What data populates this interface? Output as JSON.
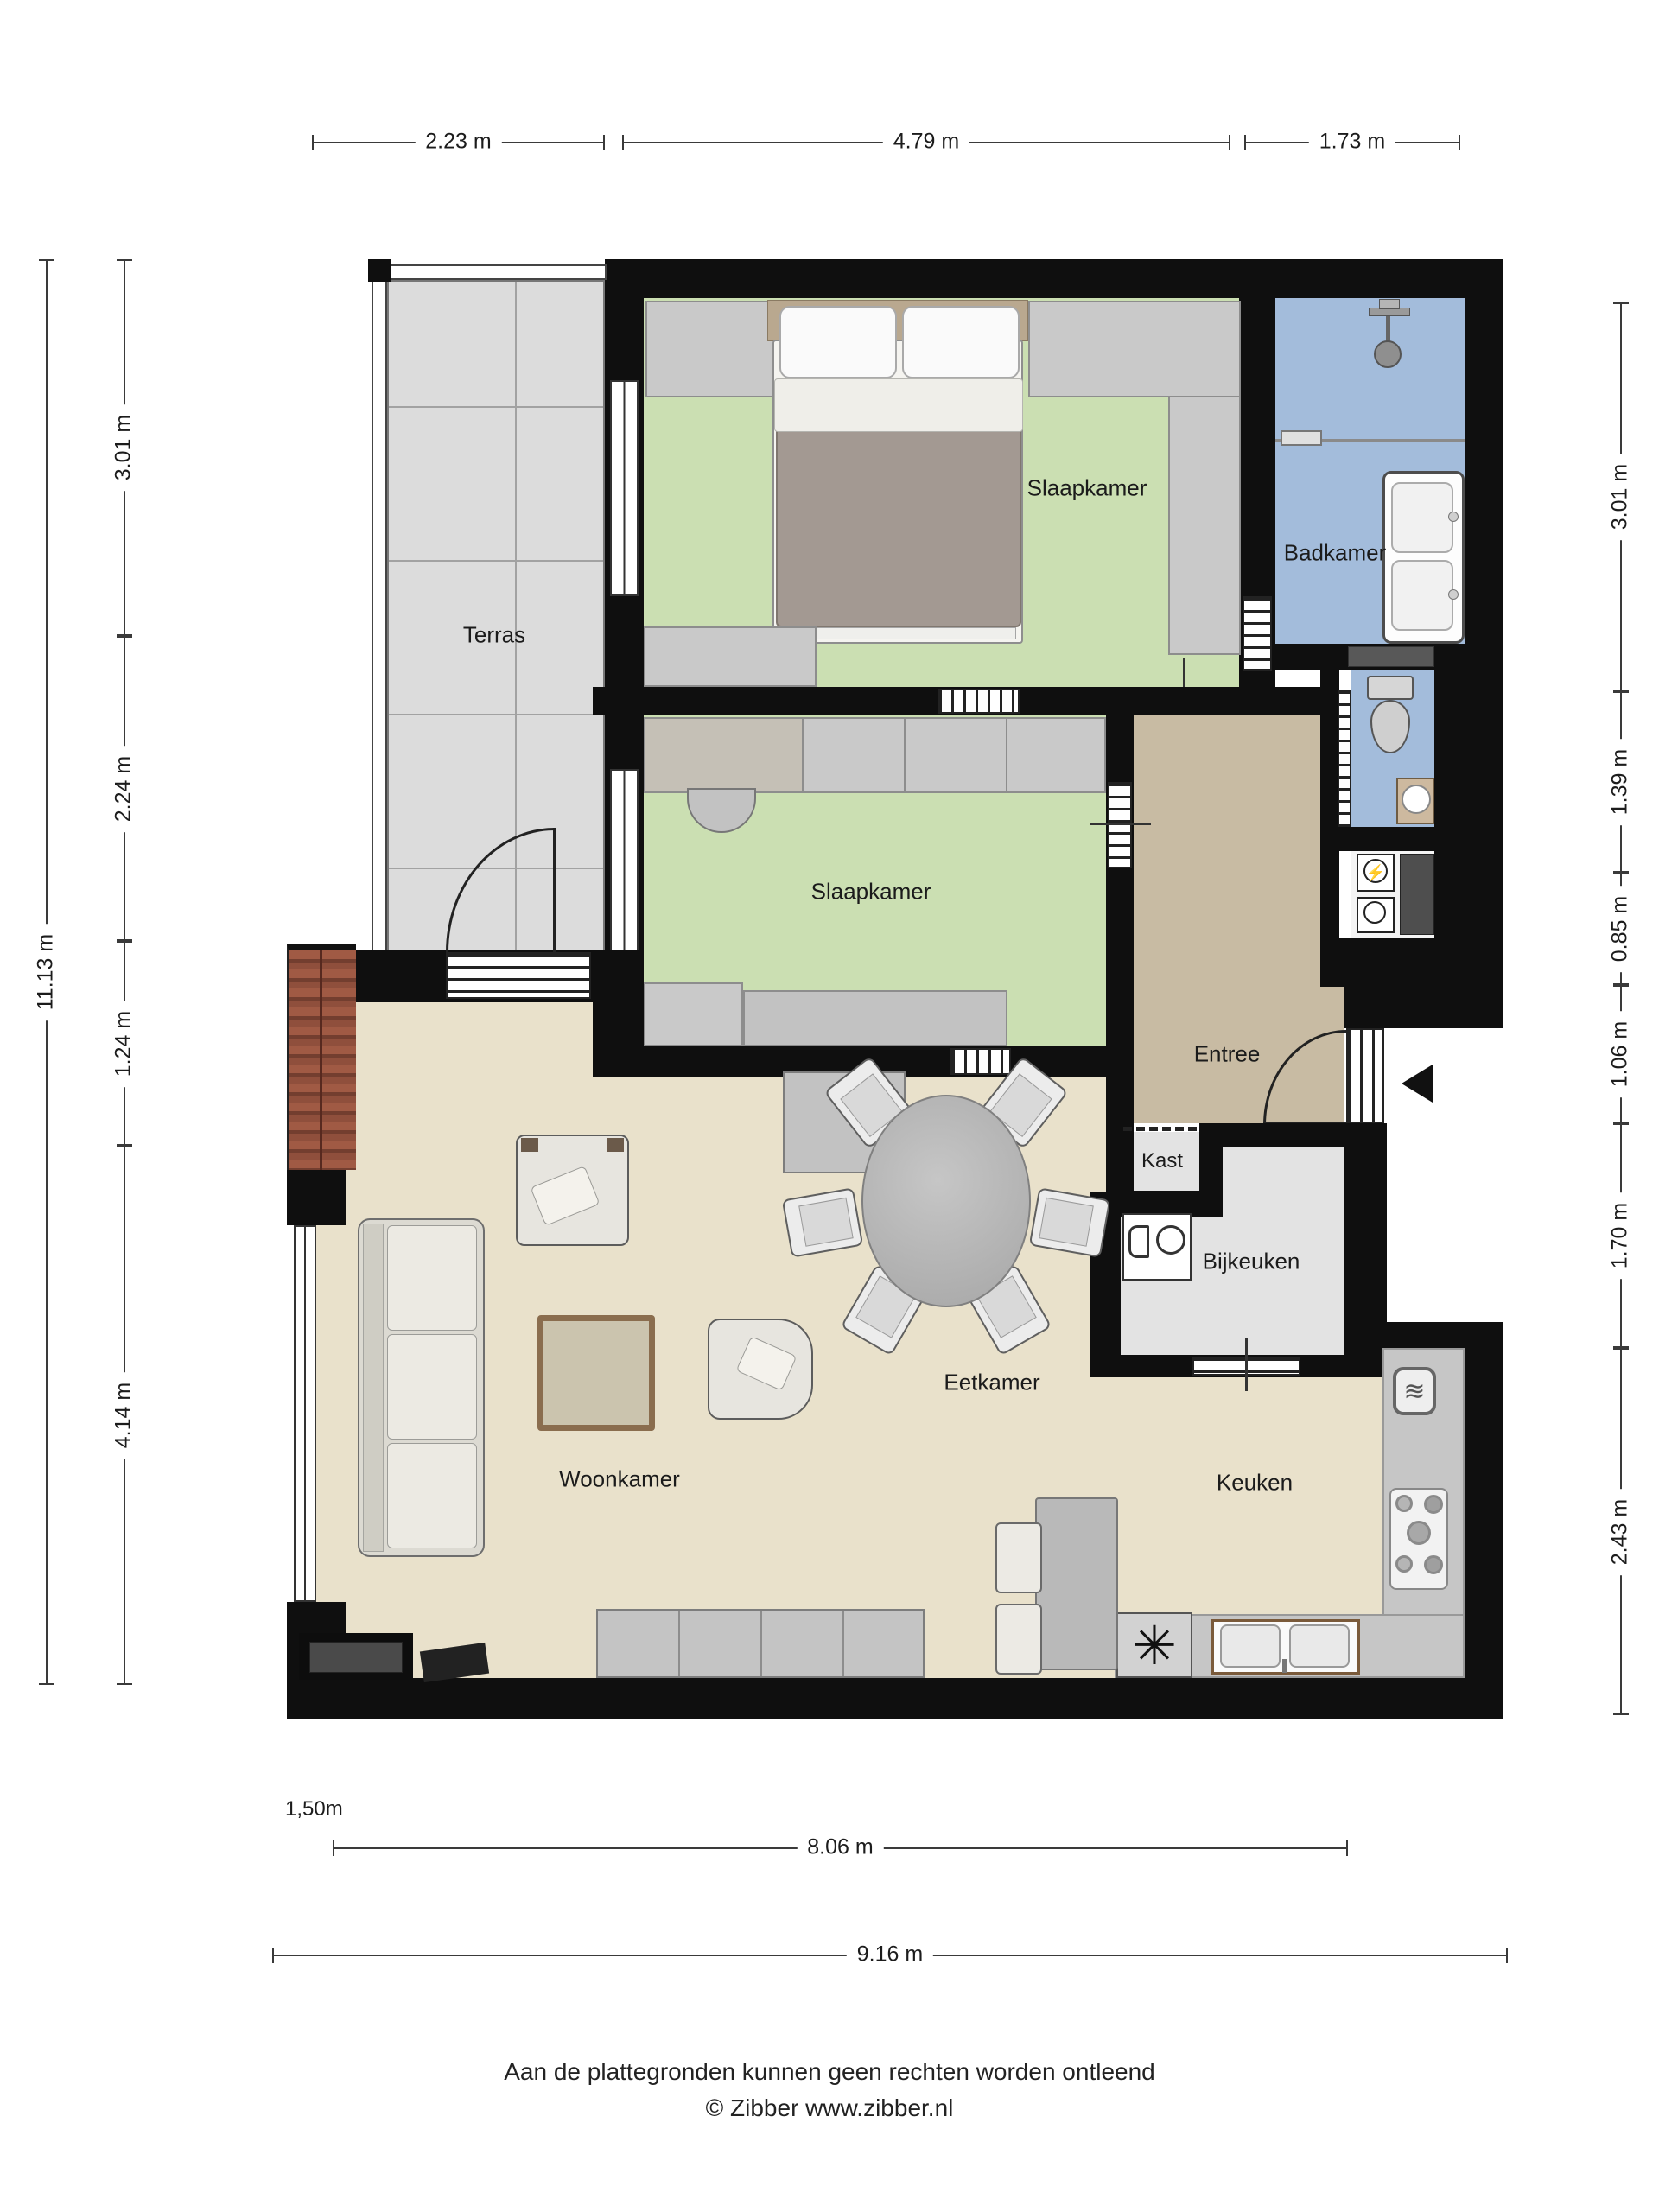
{
  "rooms": {
    "terras": "Terras",
    "slaapkamer1": "Slaapkamer",
    "badkamer": "Badkamer",
    "slaapkamer2": "Slaapkamer",
    "entree": "Entree",
    "kast": "Kast",
    "bijkeuken": "Bijkeuken",
    "eetkamer": "Eetkamer",
    "woonkamer": "Woonkamer",
    "keuken": "Keuken"
  },
  "dimensions": {
    "top": [
      "2.23 m",
      "4.79 m",
      "1.73 m"
    ],
    "left_outer": "11.13 m",
    "left_inner": [
      "3.01 m",
      "2.24 m",
      "1.24 m",
      "4.14 m"
    ],
    "right": [
      "3.01 m",
      "1.39 m",
      "0.85 m",
      "1.06 m",
      "1.70 m",
      "2.43 m"
    ],
    "bottom_offset": "1,50m",
    "bottom_inner": "8.06 m",
    "bottom_outer": "9.16 m"
  },
  "footer": {
    "disclaimer": "Aan de plattegronden kunnen geen rechten worden ontleend",
    "credit": "© Zibber www.zibber.nl"
  },
  "icons": {
    "fan": "✳",
    "heater": "≋",
    "lightning": "⚡"
  },
  "colors": {
    "wall": "#0f0f0f",
    "bedroom_floor": "#cbdfb2",
    "bathroom_floor": "#a3bcdb",
    "entree_floor": "#c8bba3",
    "living_floor": "#e9e1cb",
    "utility_floor": "#e3e3e3",
    "terras_floor": "#dcdcdc",
    "roof_tiles": "#8f4f3c",
    "counter": "#c6c6c6"
  }
}
